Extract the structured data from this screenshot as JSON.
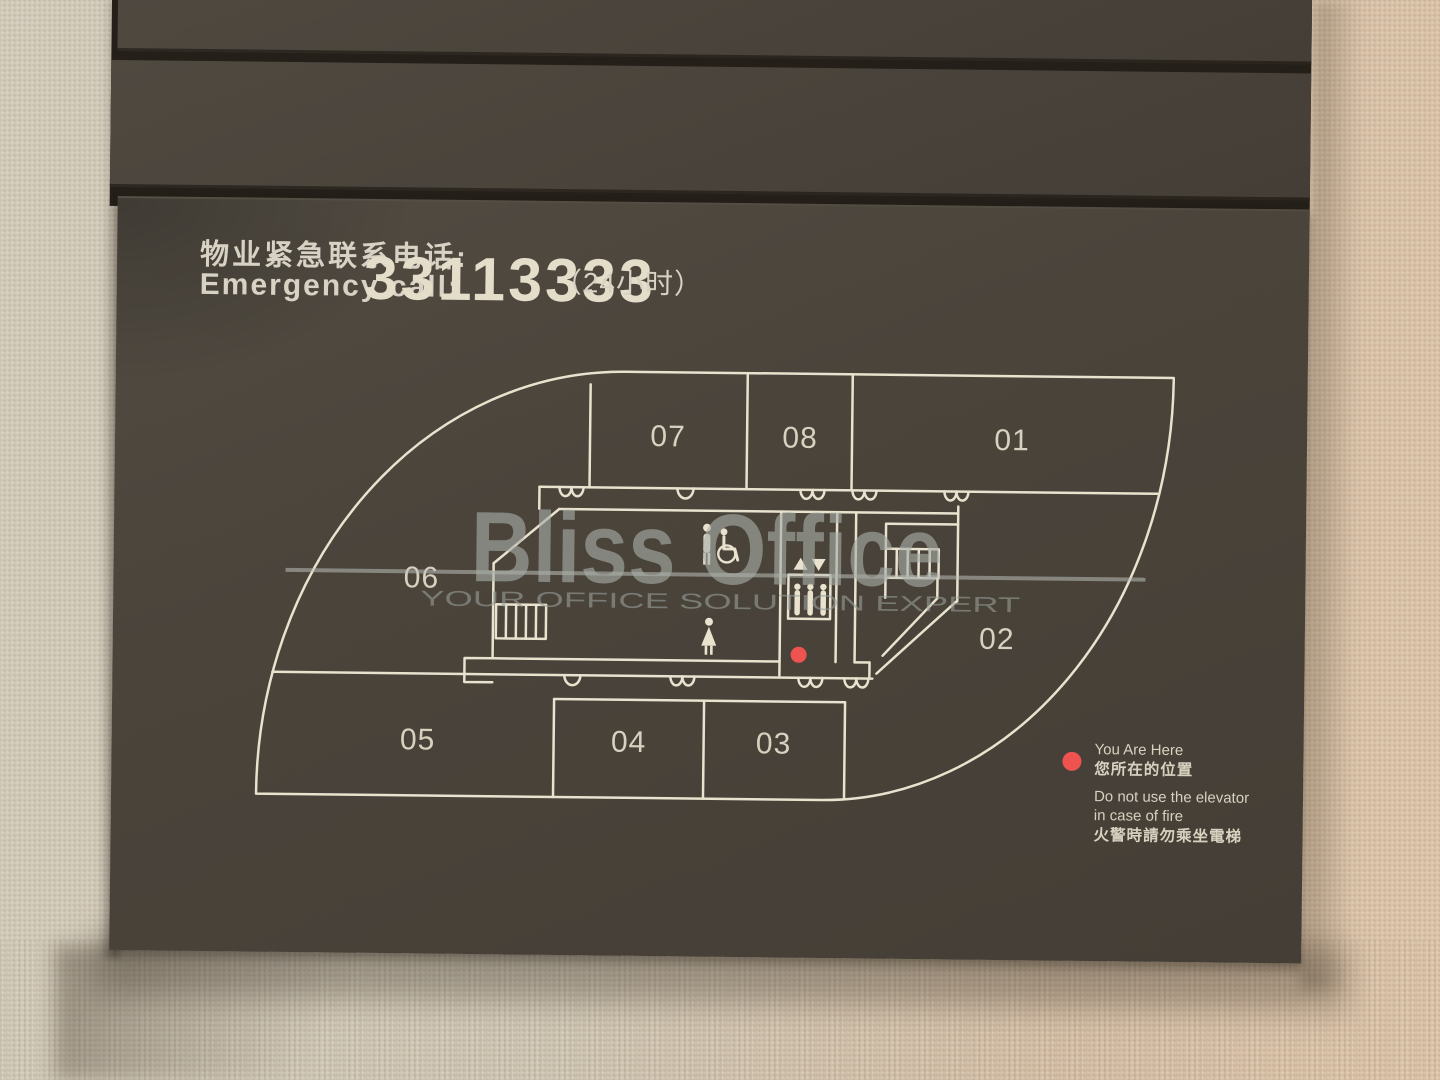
{
  "emergency_header": {
    "label_zh": "物业紧急联系电话:",
    "label_en": "Emergency call:",
    "phone": "33113333",
    "hours": "（24小时）"
  },
  "floor_plan": {
    "rooms": [
      {
        "id": "07"
      },
      {
        "id": "08"
      },
      {
        "id": "01"
      },
      {
        "id": "06"
      },
      {
        "id": "02"
      },
      {
        "id": "05"
      },
      {
        "id": "04"
      },
      {
        "id": "03"
      }
    ],
    "icons": [
      "male-figure",
      "wheelchair-accessible-toilet",
      "female-figure",
      "elevator-with-passengers",
      "elevator-up-down-arrows",
      "stairs",
      "stairs"
    ],
    "legend": {
      "you_are_here_en": "You Are Here",
      "you_are_here_zh": "您所在的位置",
      "fire_warning_line1": "Do not use the elevator",
      "fire_warning_line2": "in case of fire",
      "fire_warning_zh": "火警時請勿乘坐電梯"
    }
  },
  "watermark": {
    "brand": "Bliss Office",
    "tagline": "YOUR OFFICE SOLUTION EXPERT"
  },
  "colors": {
    "plate": "#4a443b",
    "plan_line": "#e9e2cf",
    "text": "#d7d2c3",
    "marker_red": "#ef5350",
    "wall": "#cfc5b2"
  }
}
